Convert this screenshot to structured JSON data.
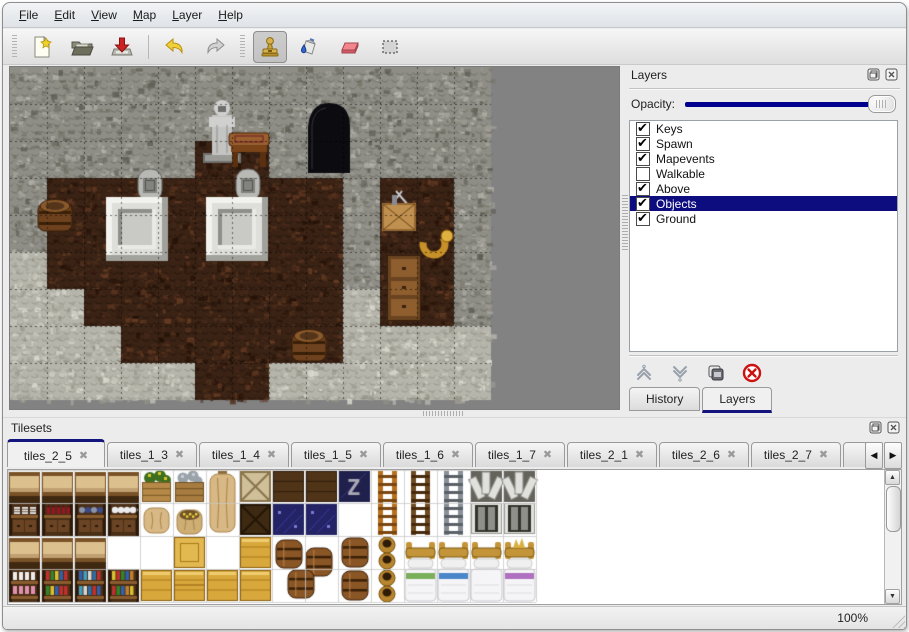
{
  "window": {
    "title": "Map Editor"
  },
  "menu_bar": {
    "items": [
      {
        "label": "File"
      },
      {
        "label": "Edit"
      },
      {
        "label": "View"
      },
      {
        "label": "Map"
      },
      {
        "label": "Layer"
      },
      {
        "label": "Help"
      }
    ]
  },
  "toolbar": {
    "buttons": [
      {
        "icon": "new-file-icon"
      },
      {
        "icon": "open-folder-icon"
      },
      {
        "icon": "save-icon"
      },
      {
        "icon": "undo-icon"
      },
      {
        "icon": "redo-icon"
      },
      {
        "icon": "stamp-tool-icon",
        "active": true
      },
      {
        "icon": "fill-bucket-icon"
      },
      {
        "icon": "eraser-icon"
      },
      {
        "icon": "select-rect-icon"
      }
    ]
  },
  "layers_panel": {
    "title": "Layers",
    "opacity_label": "Opacity:",
    "opacity_value": 100,
    "layers": [
      {
        "label": "Keys",
        "checked": true,
        "selected": false
      },
      {
        "label": "Spawn",
        "checked": true,
        "selected": false
      },
      {
        "label": "Mapevents",
        "checked": true,
        "selected": false
      },
      {
        "label": "Walkable",
        "checked": false,
        "selected": false
      },
      {
        "label": "Above",
        "checked": true,
        "selected": false
      },
      {
        "label": "Objects",
        "checked": true,
        "selected": true
      },
      {
        "label": "Ground",
        "checked": true,
        "selected": false
      }
    ],
    "buttons": [
      "move-layer-up",
      "move-layer-down",
      "duplicate-layer",
      "delete-layer"
    ],
    "tabs": [
      {
        "label": "History",
        "active": false
      },
      {
        "label": "Layers",
        "active": true
      }
    ]
  },
  "tilesets_panel": {
    "title": "Tilesets",
    "tabs": [
      {
        "label": "tiles_2_5",
        "active": true
      },
      {
        "label": "tiles_1_3",
        "active": false
      },
      {
        "label": "tiles_1_4",
        "active": false
      },
      {
        "label": "tiles_1_5",
        "active": false
      },
      {
        "label": "tiles_1_6",
        "active": false
      },
      {
        "label": "tiles_1_7",
        "active": false
      },
      {
        "label": "tiles_2_1",
        "active": false
      },
      {
        "label": "tiles_2_6",
        "active": false
      },
      {
        "label": "tiles_2_7",
        "active": false
      },
      {
        "label": "tiles_",
        "active": false,
        "truncated": true
      }
    ],
    "scroll_left": "◀",
    "scroll_right": "▶"
  },
  "status_bar": {
    "zoom": "100%"
  },
  "colors": {
    "accent_navy": "#14147e",
    "selection_navy": "#0d0d80",
    "slider_navy": "#00008e",
    "canvas_gray": "#828282",
    "wall_gray": "#8f8e86",
    "floor_brown": "#3a2315",
    "ground_light": "#b6b5ab"
  },
  "map_canvas": {
    "tile_size": 37,
    "bg": "#828282",
    "grid": [
      "WWWWWWWWWWWWW",
      "WWWWWWWWWWWWW",
      "WWWWWFFWWWWWW",
      "WFFFFFFFFWFFW",
      "WFFFFFFFFWFFW",
      "GFFFFFFFFWFFW",
      "GGFFFFFFFGFFW",
      "GGGFFFFFFGGGG",
      "GGGGGFFGGGGGG"
    ],
    "objects": [
      {
        "t": "statue",
        "x": 196,
        "y": 28
      },
      {
        "t": "table",
        "x": 219,
        "y": 66
      },
      {
        "t": "grave",
        "x": 128,
        "y": 102
      },
      {
        "t": "grave",
        "x": 226,
        "y": 102
      },
      {
        "t": "altar",
        "x": 96,
        "y": 130
      },
      {
        "t": "altar",
        "x": 196,
        "y": 130
      },
      {
        "t": "barrel",
        "x": 28,
        "y": 130
      },
      {
        "t": "door",
        "x": 298,
        "y": 36
      },
      {
        "t": "crateTools",
        "x": 372,
        "y": 126
      },
      {
        "t": "horn",
        "x": 408,
        "y": 160
      },
      {
        "t": "cabinet",
        "x": 377,
        "y": 188
      },
      {
        "t": "barrel",
        "x": 282,
        "y": 260
      }
    ]
  },
  "tileset_canvas": {
    "tile_size": 33,
    "bg": "#ffffff",
    "tiles": [
      {
        "t": "shelfTop",
        "c": 0,
        "r": 0
      },
      {
        "t": "shelfTop",
        "c": 1,
        "r": 0
      },
      {
        "t": "shelfTop",
        "c": 2,
        "r": 0
      },
      {
        "t": "shelfTop",
        "c": 3,
        "r": 0
      },
      {
        "t": "cratePlant",
        "c": 4,
        "r": 0
      },
      {
        "t": "crateOre",
        "c": 5,
        "r": 0
      },
      {
        "t": "sackTall",
        "c": 6,
        "r": 0,
        "s": 2
      },
      {
        "t": "crateLightX",
        "c": 7,
        "r": 0
      },
      {
        "t": "crateDark",
        "c": 8,
        "r": 0
      },
      {
        "t": "crateDark",
        "c": 9,
        "r": 0
      },
      {
        "t": "crateZ",
        "c": 10,
        "r": 0
      },
      {
        "t": "ladderOrange",
        "c": 11,
        "r": 0,
        "s": 2
      },
      {
        "t": "ladderBrown",
        "c": 12,
        "r": 0,
        "s": 2
      },
      {
        "t": "ladderGray",
        "c": 13,
        "r": 0,
        "s": 2
      },
      {
        "t": "gateTop",
        "c": 14,
        "r": 0
      },
      {
        "t": "gateTop",
        "c": 15,
        "r": 0
      },
      {
        "t": "shelfDishes",
        "c": 0,
        "r": 1
      },
      {
        "t": "shelfBottles",
        "c": 1,
        "r": 1
      },
      {
        "t": "shelfJars",
        "c": 2,
        "r": 1
      },
      {
        "t": "shelfTea",
        "c": 3,
        "r": 1
      },
      {
        "t": "sack",
        "c": 4,
        "r": 1
      },
      {
        "t": "sackGold",
        "c": 5,
        "r": 1
      },
      {
        "t": "crateDarkX",
        "c": 7,
        "r": 1
      },
      {
        "t": "blueTile",
        "c": 8,
        "r": 1
      },
      {
        "t": "blueTile",
        "c": 9,
        "r": 1
      },
      {
        "t": "gateBottom",
        "c": 14,
        "r": 1
      },
      {
        "t": "gateBottom",
        "c": 15,
        "r": 1
      },
      {
        "t": "shelfTop",
        "c": 0,
        "r": 2
      },
      {
        "t": "shelfTop",
        "c": 1,
        "r": 2
      },
      {
        "t": "shelfTop",
        "c": 2,
        "r": 2
      },
      {
        "t": "crateGoldTop",
        "c": 5,
        "r": 2
      },
      {
        "t": "crateGold",
        "c": 7,
        "r": 2
      },
      {
        "t": "barrelPile",
        "c": 8,
        "r": 2,
        "s": 2,
        "w": 2
      },
      {
        "t": "barrel",
        "c": 10,
        "r": 2
      },
      {
        "t": "barrel",
        "c": 10,
        "r": 3
      },
      {
        "t": "pots",
        "c": 11,
        "r": 2
      },
      {
        "t": "pots",
        "c": 11,
        "r": 3
      },
      {
        "t": "bedHead",
        "c": 12,
        "r": 2
      },
      {
        "t": "bedHead",
        "c": 13,
        "r": 2
      },
      {
        "t": "bedHead",
        "c": 14,
        "r": 2
      },
      {
        "t": "bedHeadCrown",
        "c": 15,
        "r": 2
      },
      {
        "t": "shelfPink",
        "c": 0,
        "r": 3
      },
      {
        "t": "shelfBooksA",
        "c": 1,
        "r": 3
      },
      {
        "t": "shelfBooksB",
        "c": 2,
        "r": 3
      },
      {
        "t": "shelfBooksC",
        "c": 3,
        "r": 3
      },
      {
        "t": "crateGold",
        "c": 4,
        "r": 3
      },
      {
        "t": "crateGoldStack",
        "c": 5,
        "r": 3
      },
      {
        "t": "crateGold",
        "c": 6,
        "r": 3
      },
      {
        "t": "crateGold",
        "c": 7,
        "r": 3
      },
      {
        "t": "bedGreen",
        "c": 12,
        "r": 3
      },
      {
        "t": "bedBlue",
        "c": 13,
        "r": 3
      },
      {
        "t": "bedWhite",
        "c": 14,
        "r": 3
      },
      {
        "t": "bedPurple",
        "c": 15,
        "r": 3
      }
    ]
  }
}
